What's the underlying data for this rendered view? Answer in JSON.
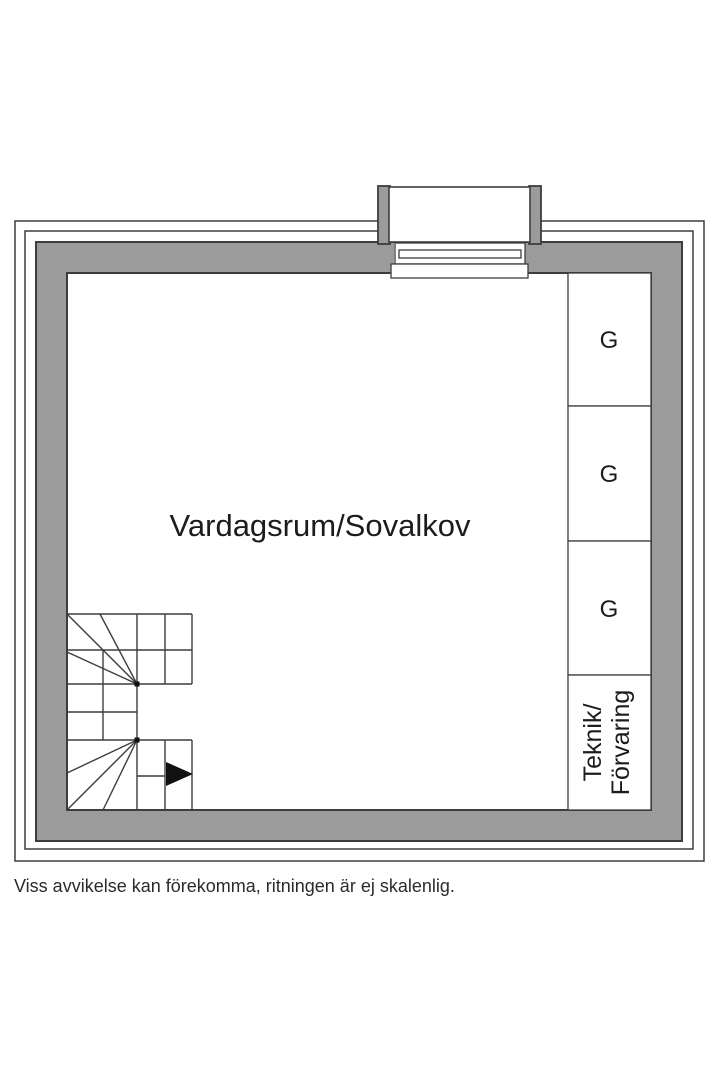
{
  "meta": {
    "disclaimer": "Viss avvikelse kan förekomma, ritningen är ej skalenlig."
  },
  "floorplan": {
    "main_room": {
      "label": "Vardagsrum/Sovalkov"
    },
    "closets": [
      {
        "label": "G"
      },
      {
        "label": "G"
      },
      {
        "label": "G"
      }
    ],
    "utility_room": {
      "label_line1": "Teknik/",
      "label_line2": "Förvaring"
    },
    "colors": {
      "wall_fill": "#9b9b9b",
      "wall_stroke": "#3d3d3d",
      "line": "#3d3d3d",
      "text": "#1c1c1c"
    }
  }
}
